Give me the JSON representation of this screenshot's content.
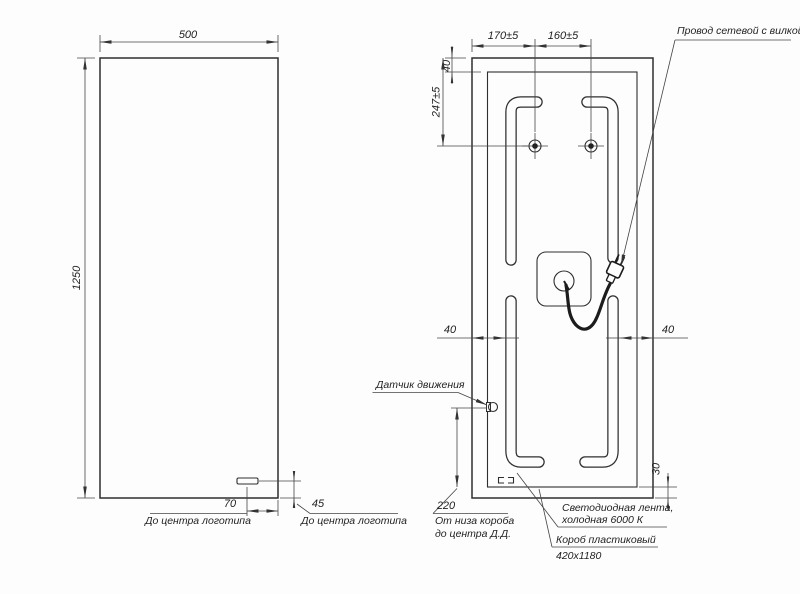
{
  "drawing": {
    "front_view": {
      "width_dim": "500",
      "height_dim": "1250",
      "logo_offset_x_dim": "70",
      "logo_offset_y_dim": "45",
      "logo_caption_left": "До центра логотипа",
      "logo_caption_right": "До центра логотипа"
    },
    "back_view": {
      "hole_left_offset_dim": "170±5",
      "hole_spacing_dim": "160±5",
      "top_gap_dim": "40",
      "holes_from_top_dim": "247±5",
      "strip_gap_left_dim": "40",
      "strip_gap_right_dim": "40",
      "bottom_gap_dim": "30",
      "sensor_height_dim": "220",
      "sensor_caption_line1": "От низа короба",
      "sensor_caption_line2": "до центра Д.Д.",
      "labels": {
        "power_cord": "Провод сетевой с вилкой",
        "motion_sensor": "Датчик движения",
        "led_strip_line1": "Светодиодная лента,",
        "led_strip_line2": "холодная 6000 К",
        "plastic_box_line1": "Короб пластиковый",
        "plastic_box_line2": "420х1180"
      }
    }
  }
}
